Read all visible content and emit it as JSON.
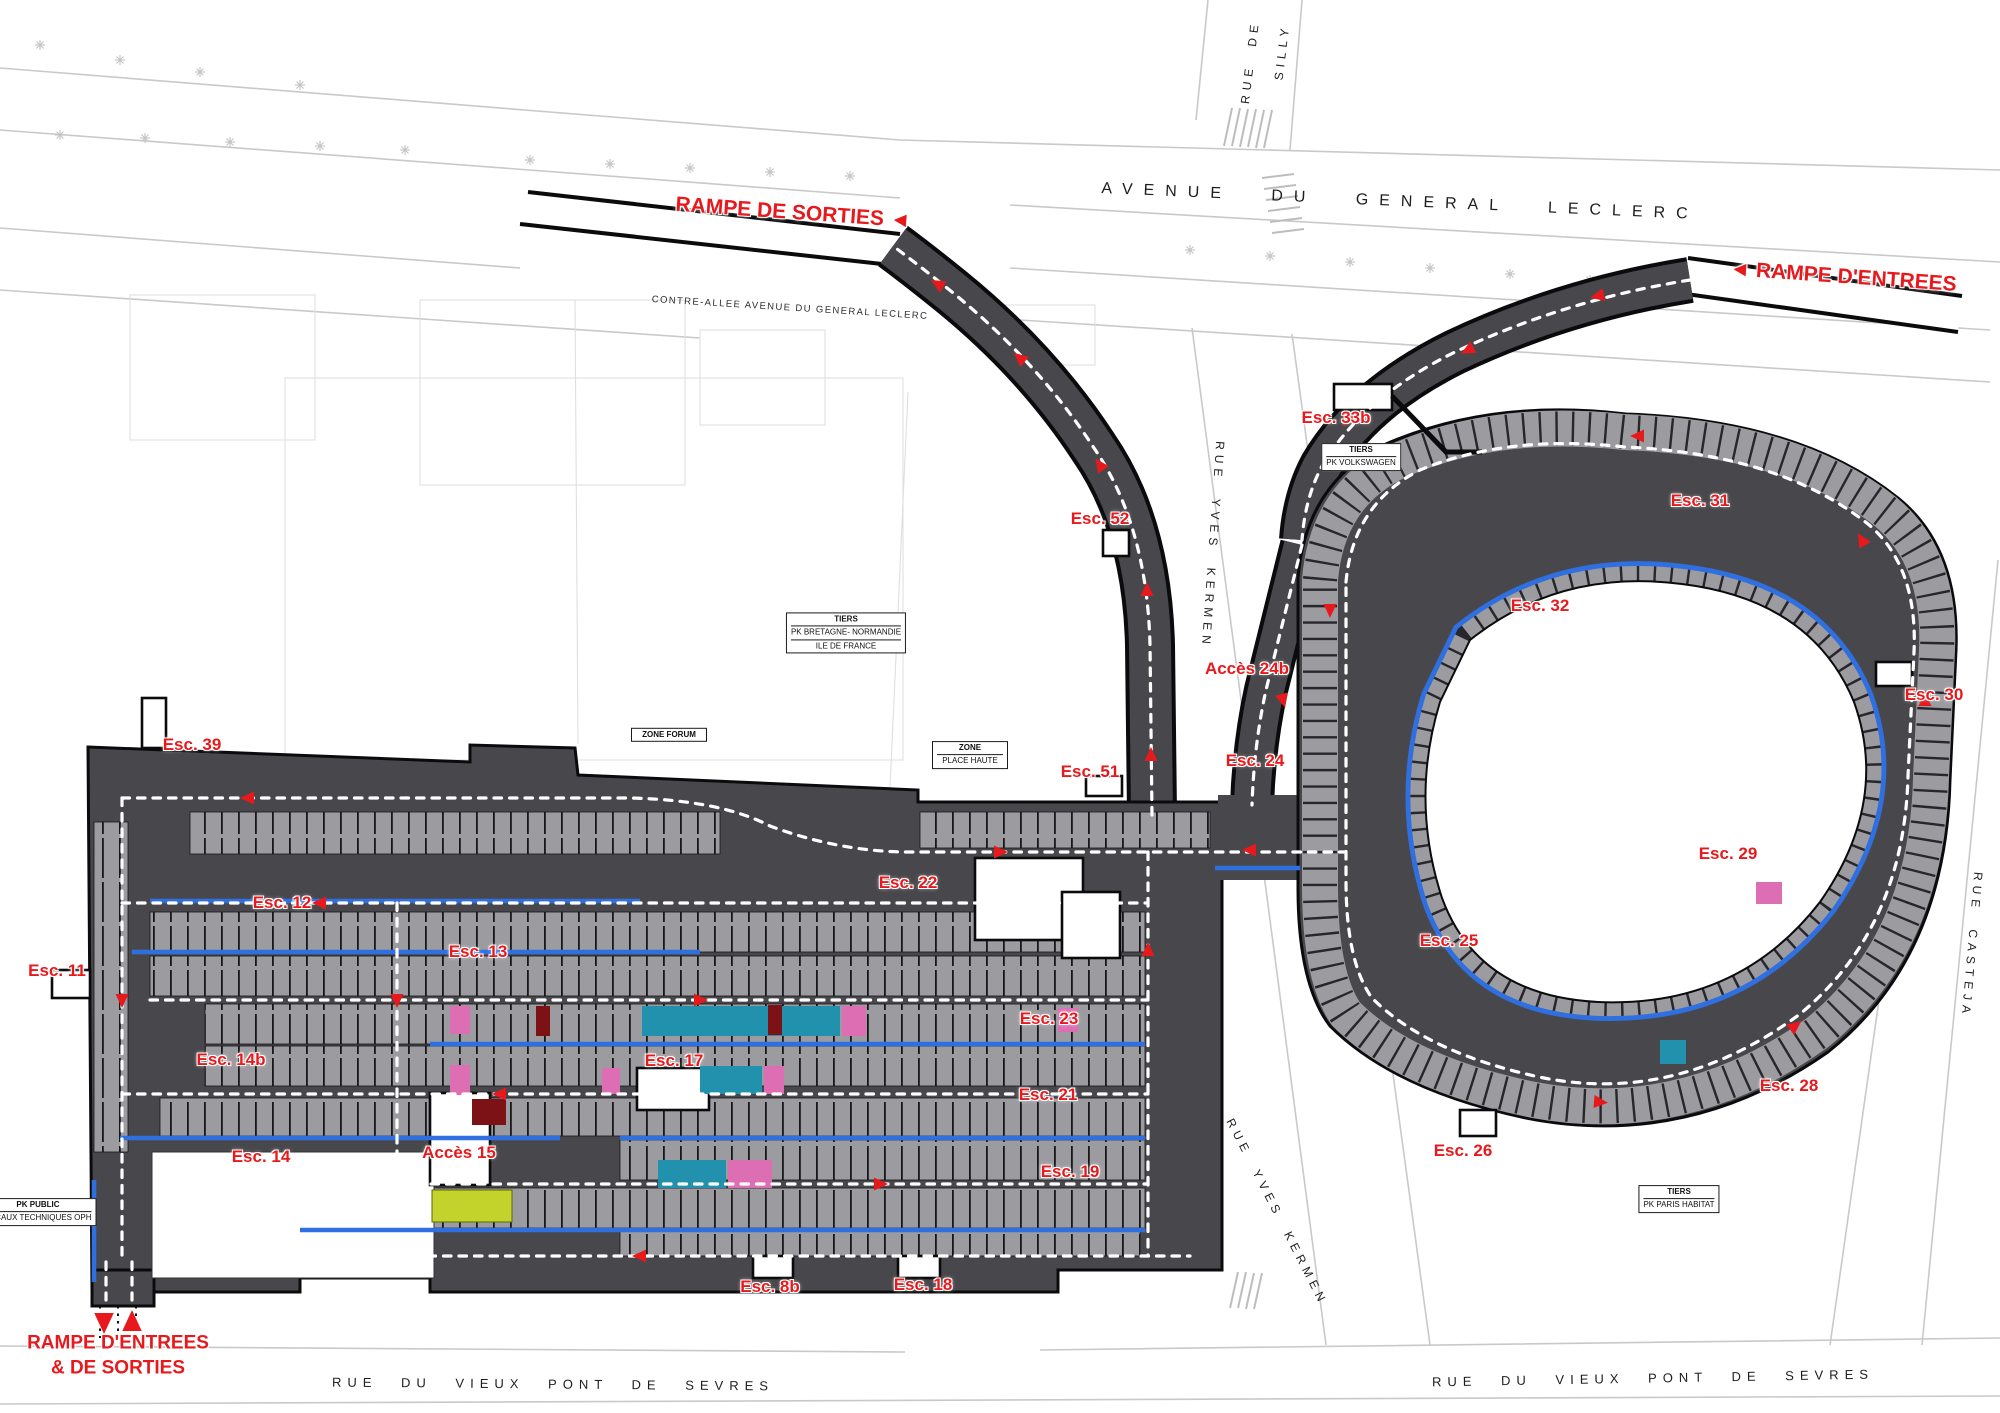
{
  "map": {
    "colors": {
      "structure": "#48484c",
      "stall-gray": "#9c9ca0",
      "accent-red": "#e8191c",
      "walkway-blue": "#2f6fe0",
      "handicap-teal": "#2191ad",
      "family-pink": "#de6eb4",
      "electric-green": "#c3d32c",
      "street-line": "#c9c9c9"
    },
    "labels": [
      {
        "id": "rampe-de-sorties",
        "type": "ramp",
        "text": "RAMPE DE SORTIES ◄",
        "x": 793,
        "y": 213,
        "rot": 4
      },
      {
        "id": "rampe-d-entrees",
        "type": "ramp",
        "text": "◄ RAMPE D'ENTREES",
        "x": 1843,
        "y": 277,
        "rot": 4
      },
      {
        "id": "rampe-entrees-sorties",
        "type": "ramp2",
        "lines": [
          "RAMPE D'ENTREES",
          "& DE SORTIES"
        ],
        "x": 118,
        "y": 1356,
        "rot": 0
      },
      {
        "id": "avenue-du-general-leclerc",
        "type": "street-lg",
        "text": "AVENUE DU GENERAL LECLERC",
        "x": 1400,
        "y": 202,
        "rot": 2.5
      },
      {
        "id": "contre-allee",
        "type": "street-sm",
        "text": "CONTRE-ALLEE AVENUE DU GENERAL LECLERC",
        "x": 790,
        "y": 308,
        "rot": 3.5
      },
      {
        "id": "rue-de-silly-line1",
        "type": "street-md",
        "text": "RUE DE",
        "x": 1250,
        "y": 62,
        "rot": -83
      },
      {
        "id": "rue-de-silly-line2",
        "type": "street-md",
        "text": "SILLY",
        "x": 1282,
        "y": 52,
        "rot": -83
      },
      {
        "id": "rue-yves-kermen-north",
        "type": "street-md",
        "text": "RUE YVES KERMEN",
        "x": 1213,
        "y": 545,
        "rot": 94
      },
      {
        "id": "rue-yves-kermen-south",
        "type": "street-md",
        "text": "RUE YVES KERMEN",
        "x": 1277,
        "y": 1212,
        "rot": 63
      },
      {
        "id": "rue-casteja",
        "type": "street-md",
        "text": "RUE CASTEJA",
        "x": 1972,
        "y": 945,
        "rot": 95
      },
      {
        "id": "rue-du-vieux-pont-de-sevres-west",
        "type": "street-lg2",
        "text": "RUE DU VIEUX PONT DE SEVRES",
        "x": 553,
        "y": 1384,
        "rot": 0.5
      },
      {
        "id": "rue-du-vieux-pont-de-sevres-east",
        "type": "street-lg2",
        "text": "RUE DU VIEUX PONT DE SEVRES",
        "x": 1653,
        "y": 1378,
        "rot": -1
      },
      {
        "id": "esc-39",
        "type": "esc",
        "text": "Esc. 39",
        "x": 192,
        "y": 745,
        "rot": 0
      },
      {
        "id": "esc-52",
        "type": "esc",
        "text": "Esc. 52",
        "x": 1100,
        "y": 519,
        "rot": 0
      },
      {
        "id": "esc-33b",
        "type": "esc",
        "text": "Esc. 33b",
        "x": 1336,
        "y": 418,
        "rot": 0
      },
      {
        "id": "esc-31",
        "type": "esc",
        "text": "Esc. 31",
        "x": 1700,
        "y": 501,
        "rot": 0
      },
      {
        "id": "esc-32",
        "type": "esc",
        "text": "Esc. 32",
        "x": 1540,
        "y": 606,
        "rot": 0
      },
      {
        "id": "acces-24b",
        "type": "esc",
        "text": "Accès 24b",
        "x": 1247,
        "y": 669,
        "rot": 0
      },
      {
        "id": "esc-30",
        "type": "esc",
        "text": "Esc. 30",
        "x": 1934,
        "y": 695,
        "rot": 0
      },
      {
        "id": "esc-24",
        "type": "esc",
        "text": "Esc. 24",
        "x": 1255,
        "y": 761,
        "rot": 0
      },
      {
        "id": "esc-51",
        "type": "esc",
        "text": "Esc. 51",
        "x": 1090,
        "y": 772,
        "rot": 0
      },
      {
        "id": "esc-29",
        "type": "esc",
        "text": "Esc. 29",
        "x": 1728,
        "y": 854,
        "rot": 0
      },
      {
        "id": "esc-22",
        "type": "esc",
        "text": "Esc. 22",
        "x": 908,
        "y": 883,
        "rot": 0
      },
      {
        "id": "esc-12",
        "type": "esc",
        "text": "Esc. 12",
        "x": 282,
        "y": 903,
        "rot": 0
      },
      {
        "id": "esc-25",
        "type": "esc",
        "text": "Esc. 25",
        "x": 1449,
        "y": 941,
        "rot": 0
      },
      {
        "id": "esc-13",
        "type": "esc",
        "text": "Esc. 13",
        "x": 478,
        "y": 952,
        "rot": 0
      },
      {
        "id": "esc-11",
        "type": "esc",
        "text": "Esc. 11",
        "x": 57,
        "y": 971,
        "rot": 0
      },
      {
        "id": "esc-23",
        "type": "esc",
        "text": "Esc. 23",
        "x": 1049,
        "y": 1019,
        "rot": 0
      },
      {
        "id": "esc-14b",
        "type": "esc",
        "text": "Esc. 14b",
        "x": 231,
        "y": 1060,
        "rot": 0
      },
      {
        "id": "esc-17",
        "type": "esc",
        "text": "Esc. 17",
        "x": 674,
        "y": 1061,
        "rot": 0
      },
      {
        "id": "esc-28",
        "type": "esc",
        "text": "Esc. 28",
        "x": 1789,
        "y": 1086,
        "rot": 0
      },
      {
        "id": "esc-21",
        "type": "esc",
        "text": "Esc. 21",
        "x": 1048,
        "y": 1095,
        "rot": 0
      },
      {
        "id": "esc-14",
        "type": "esc",
        "text": "Esc. 14",
        "x": 261,
        "y": 1157,
        "rot": 0
      },
      {
        "id": "acces-15",
        "type": "esc",
        "text": "Accès 15",
        "x": 459,
        "y": 1153,
        "rot": 0
      },
      {
        "id": "esc-26",
        "type": "esc",
        "text": "Esc. 26",
        "x": 1463,
        "y": 1151,
        "rot": 0
      },
      {
        "id": "esc-19",
        "type": "esc",
        "text": "Esc. 19",
        "x": 1070,
        "y": 1172,
        "rot": 0
      },
      {
        "id": "esc-8b",
        "type": "esc",
        "text": "Esc. 8b",
        "x": 770,
        "y": 1287,
        "rot": 0
      },
      {
        "id": "esc-18",
        "type": "esc",
        "text": "Esc. 18",
        "x": 923,
        "y": 1285,
        "rot": 0
      },
      {
        "id": "tiers-volkswagen",
        "type": "boxed",
        "lines": [
          "TIERS",
          "PK VOLKSWAGEN"
        ],
        "x": 1361,
        "y": 457,
        "rot": 0
      },
      {
        "id": "tiers-bretagne-normandie",
        "type": "boxed",
        "lines": [
          "TIERS",
          "PK BRETAGNE- NORMANDIE",
          "ILE DE FRANCE"
        ],
        "x": 846,
        "y": 633,
        "rot": 0
      },
      {
        "id": "zone-forum",
        "type": "boxed",
        "lines": [
          "ZONE FORUM"
        ],
        "x": 669,
        "y": 735,
        "rot": 0
      },
      {
        "id": "zone-place-haute",
        "type": "boxed",
        "lines": [
          "ZONE",
          "PLACE HAUTE"
        ],
        "x": 970,
        "y": 755,
        "rot": 0
      },
      {
        "id": "tiers-paris-habitat",
        "type": "boxed",
        "lines": [
          "TIERS",
          "PK PARIS HABITAT"
        ],
        "x": 1679,
        "y": 1199,
        "rot": 0
      },
      {
        "id": "pk-public",
        "type": "boxed",
        "lines": [
          "PK PUBLIC",
          "LOCAUX TECHNIQUES OPH"
        ],
        "x": 38,
        "y": 1212,
        "rot": 0
      }
    ]
  }
}
